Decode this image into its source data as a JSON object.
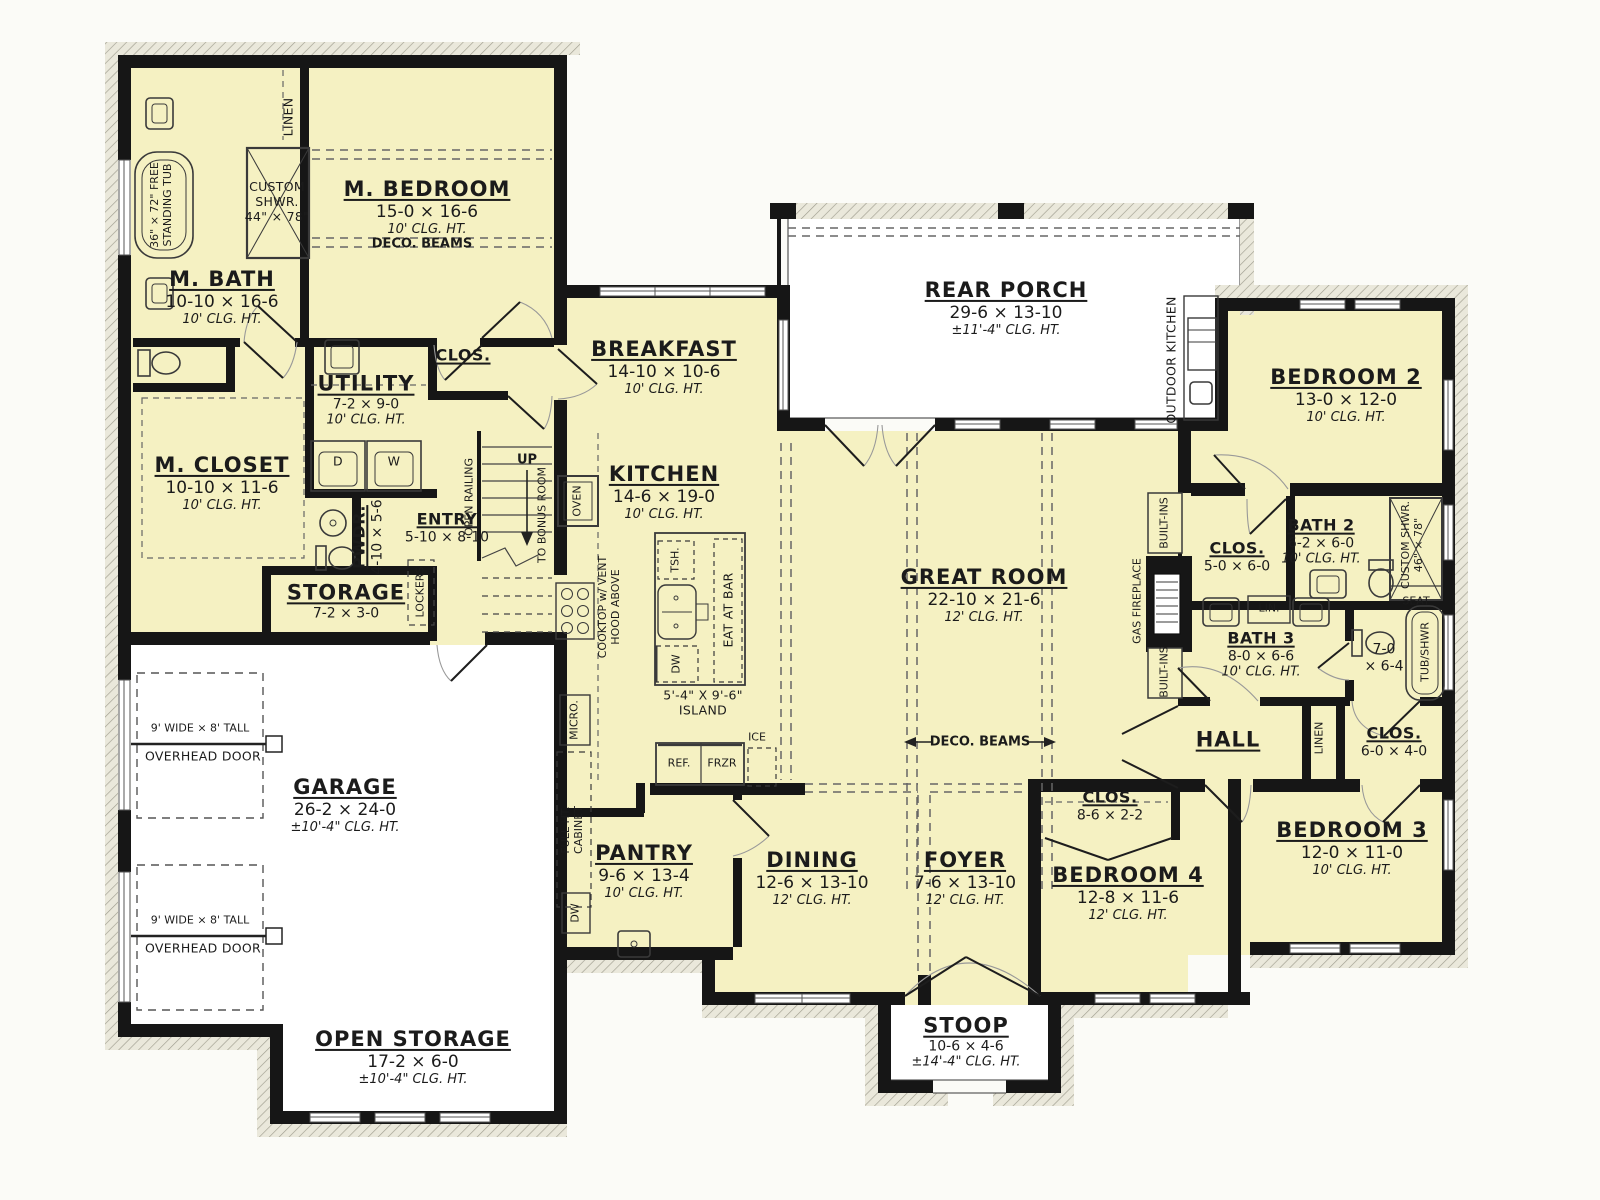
{
  "colors": {
    "room_fill": "#f5f1c2",
    "wall": "#161616",
    "paper": "#fbfbf7",
    "hatch_fill": "#eae8db",
    "hatch_line": "#a09e90"
  },
  "rooms": {
    "m_bedroom": {
      "n": "M. BEDROOM",
      "d": "15-0 × 16-6",
      "c": "10' CLG. HT."
    },
    "m_bath": {
      "n": "M. BATH",
      "d": "10-10 × 16-6",
      "c": "10' CLG. HT."
    },
    "m_closet": {
      "n": "M. CLOSET",
      "d": "10-10 × 11-6",
      "c": "10' CLG. HT."
    },
    "utility": {
      "n": "UTILITY",
      "d": "7-2 × 9-0",
      "c": "10' CLG. HT."
    },
    "clos_utility": {
      "n": "CLOS."
    },
    "pwdr": {
      "n": "PWDR.",
      "d": "4-10 × 5-6"
    },
    "entry": {
      "n": "ENTRY",
      "d": "5-10 × 8-10"
    },
    "storage": {
      "n": "STORAGE",
      "d": "7-2 × 3-0"
    },
    "garage": {
      "n": "GARAGE",
      "d": "26-2 × 24-0",
      "c": "±10'-4\" CLG. HT."
    },
    "open_storage": {
      "n": "OPEN STORAGE",
      "d": "17-2 × 6-0",
      "c": "±10'-4\" CLG. HT."
    },
    "breakfast": {
      "n": "BREAKFAST",
      "d": "14-10 × 10-6",
      "c": "10' CLG. HT."
    },
    "kitchen": {
      "n": "KITCHEN",
      "d": "14-6 × 19-0",
      "c": "10' CLG. HT."
    },
    "pantry": {
      "n": "PANTRY",
      "d": "9-6 × 13-4",
      "c": "10' CLG. HT."
    },
    "rear_porch": {
      "n": "REAR PORCH",
      "d": "29-6 × 13-10",
      "c": "±11'-4\" CLG. HT."
    },
    "great_room": {
      "n": "GREAT ROOM",
      "d": "22-10 × 21-6",
      "c": "12' CLG. HT."
    },
    "dining": {
      "n": "DINING",
      "d": "12-6 × 13-10",
      "c": "12' CLG. HT."
    },
    "foyer": {
      "n": "FOYER",
      "d": "7-6 × 13-10",
      "c": "12' CLG. HT."
    },
    "stoop": {
      "n": "STOOP",
      "d": "10-6 × 4-6",
      "c": "±14'-4\" CLG. HT."
    },
    "bedroom2": {
      "n": "BEDROOM 2",
      "d": "13-0 × 12-0",
      "c": "10' CLG. HT."
    },
    "bedroom3": {
      "n": "BEDROOM 3",
      "d": "12-0 × 11-0",
      "c": "10' CLG. HT."
    },
    "bedroom4": {
      "n": "BEDROOM 4",
      "d": "12-8 × 11-6",
      "c": "12' CLG. HT."
    },
    "bath2": {
      "n": "BATH 2",
      "d": "6-2 × 6-0",
      "c": "10' CLG. HT."
    },
    "bath3": {
      "n": "BATH 3",
      "d": "8-0 × 6-6",
      "c": "10' CLG. HT."
    },
    "clos_bed2": {
      "n": "CLOS.",
      "d": "5-0 × 6-0"
    },
    "clos_hall": {
      "n": "CLOS.",
      "d": "6-0 × 4-0"
    },
    "clos_bed4": {
      "n": "CLOS.",
      "d": "8-6 × 2-2"
    },
    "hall": {
      "n": "HALL"
    },
    "tub_room": {
      "d1": "7-0",
      "d2": "× 6-4"
    }
  },
  "labels": {
    "linen": "LINEN",
    "custom": "CUSTOM",
    "shwr": "SHWR.",
    "size44": "44\" × 78\"",
    "size46": "46\" × 78\"",
    "free_tub1": "36\" × 72\" FREE",
    "free_tub2": "STANDING TUB",
    "deco_beams": "DECO. BEAMS",
    "open_railing": "OPEN RAILING",
    "up": "UP",
    "to_bonus": "TO BONUS ROOM",
    "lockers": "LOCKERS",
    "oven": "OVEN",
    "cooktop1": "COOKTOP w/ VENT",
    "cooktop2": "HOOD ABOVE",
    "micro": "MICRO.",
    "tsh": "TSH.",
    "eat_at_bar": "EAT AT BAR",
    "dw": "DW",
    "island1": "5'-4\" X 9'-6\"",
    "island2": "ISLAND",
    "ref": "REF.",
    "frzr": "FRZR",
    "ice": "ICE",
    "full_ht1": "FULL HT.",
    "full_ht2": "CABINET",
    "d": "D",
    "w": "W",
    "ohd1": "9' WIDE × 8' TALL",
    "ohd2": "OVERHEAD DOOR",
    "outdoor_kitchen": "OUTDOOR KITCHEN",
    "gas_fireplace": "GAS FIREPLACE",
    "built_ins": "BUILT-INS",
    "lin": "LIN.",
    "tub_shwr": "TUB/SHWR",
    "custom_shwr2": "CUSTOM SHWR.",
    "seat": "SEAT"
  }
}
